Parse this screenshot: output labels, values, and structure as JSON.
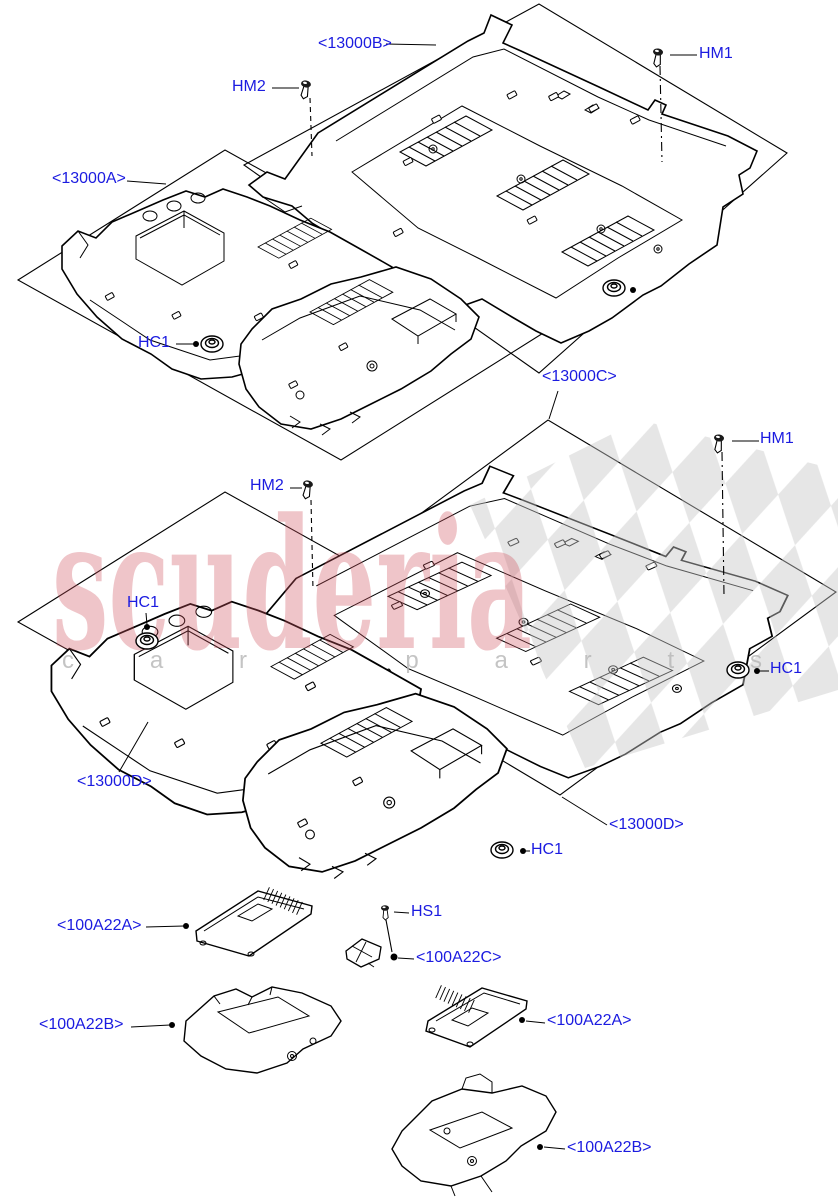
{
  "diagram": {
    "part_labels": {
      "floor_rear_b": "<13000B>",
      "floor_front_a": "<13000A>",
      "floor_rear_c": "<13000C>",
      "floor_front_d": "<13000D>",
      "insulator_a": "<100A22A>",
      "insulator_b": "<100A22B>",
      "insulator_c": "<100A22C>"
    },
    "fastener_labels": {
      "hm1": "HM1",
      "hm2": "HM2",
      "hc1": "HC1",
      "hs1": "HS1"
    }
  },
  "watermark": {
    "brand": "scuderia",
    "tagline": "car parts"
  },
  "colors": {
    "label_blue": "#1b1be0",
    "line_black": "#000000",
    "watermark_pink": "#cf5560",
    "watermark_gray": "#b5b5b5",
    "checker_gray": "#c9c9c9",
    "background": "#ffffff"
  }
}
